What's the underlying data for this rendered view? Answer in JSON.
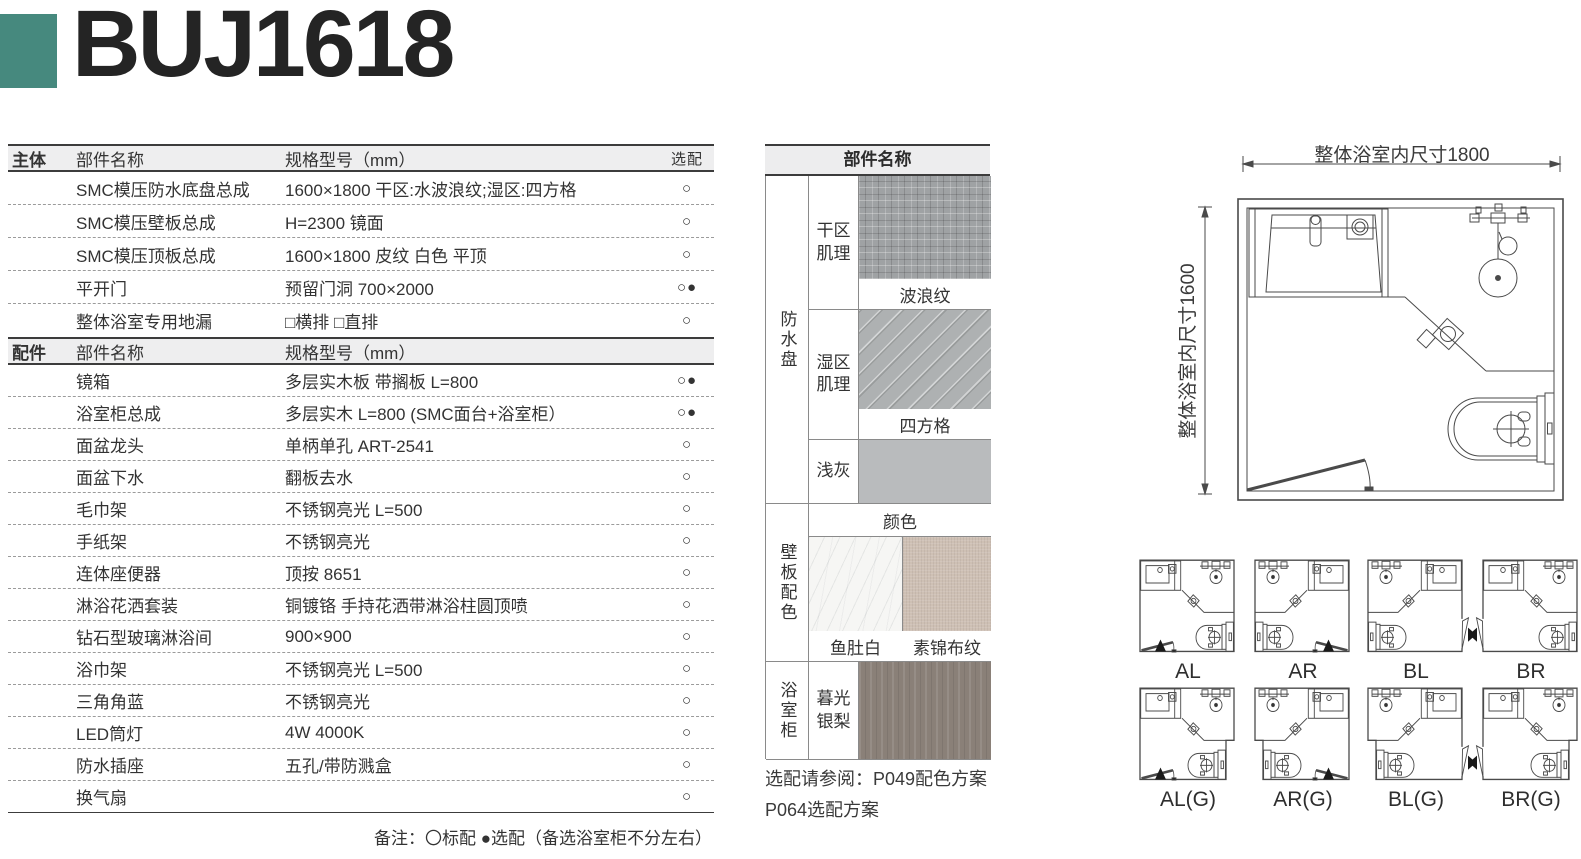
{
  "page": {
    "title": "BUJ1618",
    "accent_color": "#46897E"
  },
  "spec_table": {
    "marks": {
      "standard": "○",
      "optional": "●"
    },
    "sections": [
      {
        "header": {
          "col1": "主体",
          "col2": "部件名称",
          "col3": "规格型号（mm）",
          "col4": "选配"
        },
        "rows": [
          {
            "name": "SMC模压防水底盘总成",
            "spec": "1600×1800 干区:水波浪纹;湿区:四方格",
            "standard": true,
            "optional": false
          },
          {
            "name": "SMC模压壁板总成",
            "spec": "H=2300 镜面",
            "standard": true,
            "optional": false
          },
          {
            "name": "SMC模压顶板总成",
            "spec": "1600×1800 皮纹 白色 平顶",
            "standard": true,
            "optional": false
          },
          {
            "name": "平开门",
            "spec": "预留门洞 700×2000",
            "standard": true,
            "optional": true
          },
          {
            "name": "整体浴室专用地漏",
            "spec": "□横排 □直排",
            "standard": true,
            "optional": false
          }
        ]
      },
      {
        "header": {
          "col1": "配件",
          "col2": "部件名称",
          "col3": "规格型号（mm）",
          "col4": ""
        },
        "rows": [
          {
            "name": "镜箱",
            "spec": "多层实木板 带搁板 L=800",
            "standard": true,
            "optional": true
          },
          {
            "name": "浴室柜总成",
            "spec": "多层实木 L=800 (SMC面台+浴室柜）",
            "standard": true,
            "optional": true
          },
          {
            "name": "面盆龙头",
            "spec": "单柄单孔 ART-2541",
            "standard": true,
            "optional": false
          },
          {
            "name": "面盆下水",
            "spec": "翻板去水",
            "standard": true,
            "optional": false
          },
          {
            "name": "毛巾架",
            "spec": "不锈钢亮光 L=500",
            "standard": true,
            "optional": false
          },
          {
            "name": "手纸架",
            "spec": "不锈钢亮光",
            "standard": true,
            "optional": false
          },
          {
            "name": "连体座便器",
            "spec": "顶按 8651",
            "standard": true,
            "optional": false
          },
          {
            "name": "淋浴花洒套装",
            "spec": "铜镀铬 手持花洒带淋浴柱圆顶喷",
            "standard": true,
            "optional": false
          },
          {
            "name": "钻石型玻璃淋浴间",
            "spec": "900×900",
            "standard": true,
            "optional": false
          },
          {
            "name": "浴巾架",
            "spec": "不锈钢亮光 L=500",
            "standard": true,
            "optional": false
          },
          {
            "name": "三角角蓝",
            "spec": "不锈钢亮光",
            "standard": true,
            "optional": false
          },
          {
            "name": "LED筒灯",
            "spec": "4W 4000K",
            "standard": true,
            "optional": false
          },
          {
            "name": "防水插座",
            "spec": "五孔/带防溅盒",
            "standard": true,
            "optional": false
          },
          {
            "name": "换气扇",
            "spec": "",
            "standard": true,
            "optional": false
          }
        ]
      }
    ],
    "footnote": "备注：〇标配 ●选配（备选浴室柜不分左右）"
  },
  "materials_panel": {
    "header": "部件名称",
    "groups": [
      {
        "name": "防水盘",
        "items": [
          {
            "label": "干区肌理",
            "caption": "波浪纹",
            "color": "#9FA2A4"
          },
          {
            "label": "湿区肌理",
            "caption": "四方格",
            "color": "#AEB1B2"
          },
          {
            "label": "浅灰",
            "caption": "颜色",
            "color": "#B9BBBD"
          }
        ]
      },
      {
        "name": "壁板配色",
        "items": [
          {
            "label": "鱼肚白",
            "color": "#F6F6F4"
          },
          {
            "label": "素锦布纹",
            "color": "#CEC0B4"
          }
        ]
      },
      {
        "name": "浴室柜",
        "items": [
          {
            "label": "暮光银梨",
            "color": "#8A8078"
          }
        ]
      }
    ],
    "note_line1": "选配请参阅：P049配色方案",
    "note_line2": "P064选配方案"
  },
  "floorplan": {
    "width_label": "整体浴室内尺寸1800",
    "height_label": "整体浴室内尺寸1600"
  },
  "layouts": {
    "rows": [
      [
        "AL",
        "AR",
        "BL",
        "BR"
      ],
      [
        "AL(G)",
        "AR(G)",
        "BL(G)",
        "BR(G)"
      ]
    ]
  }
}
